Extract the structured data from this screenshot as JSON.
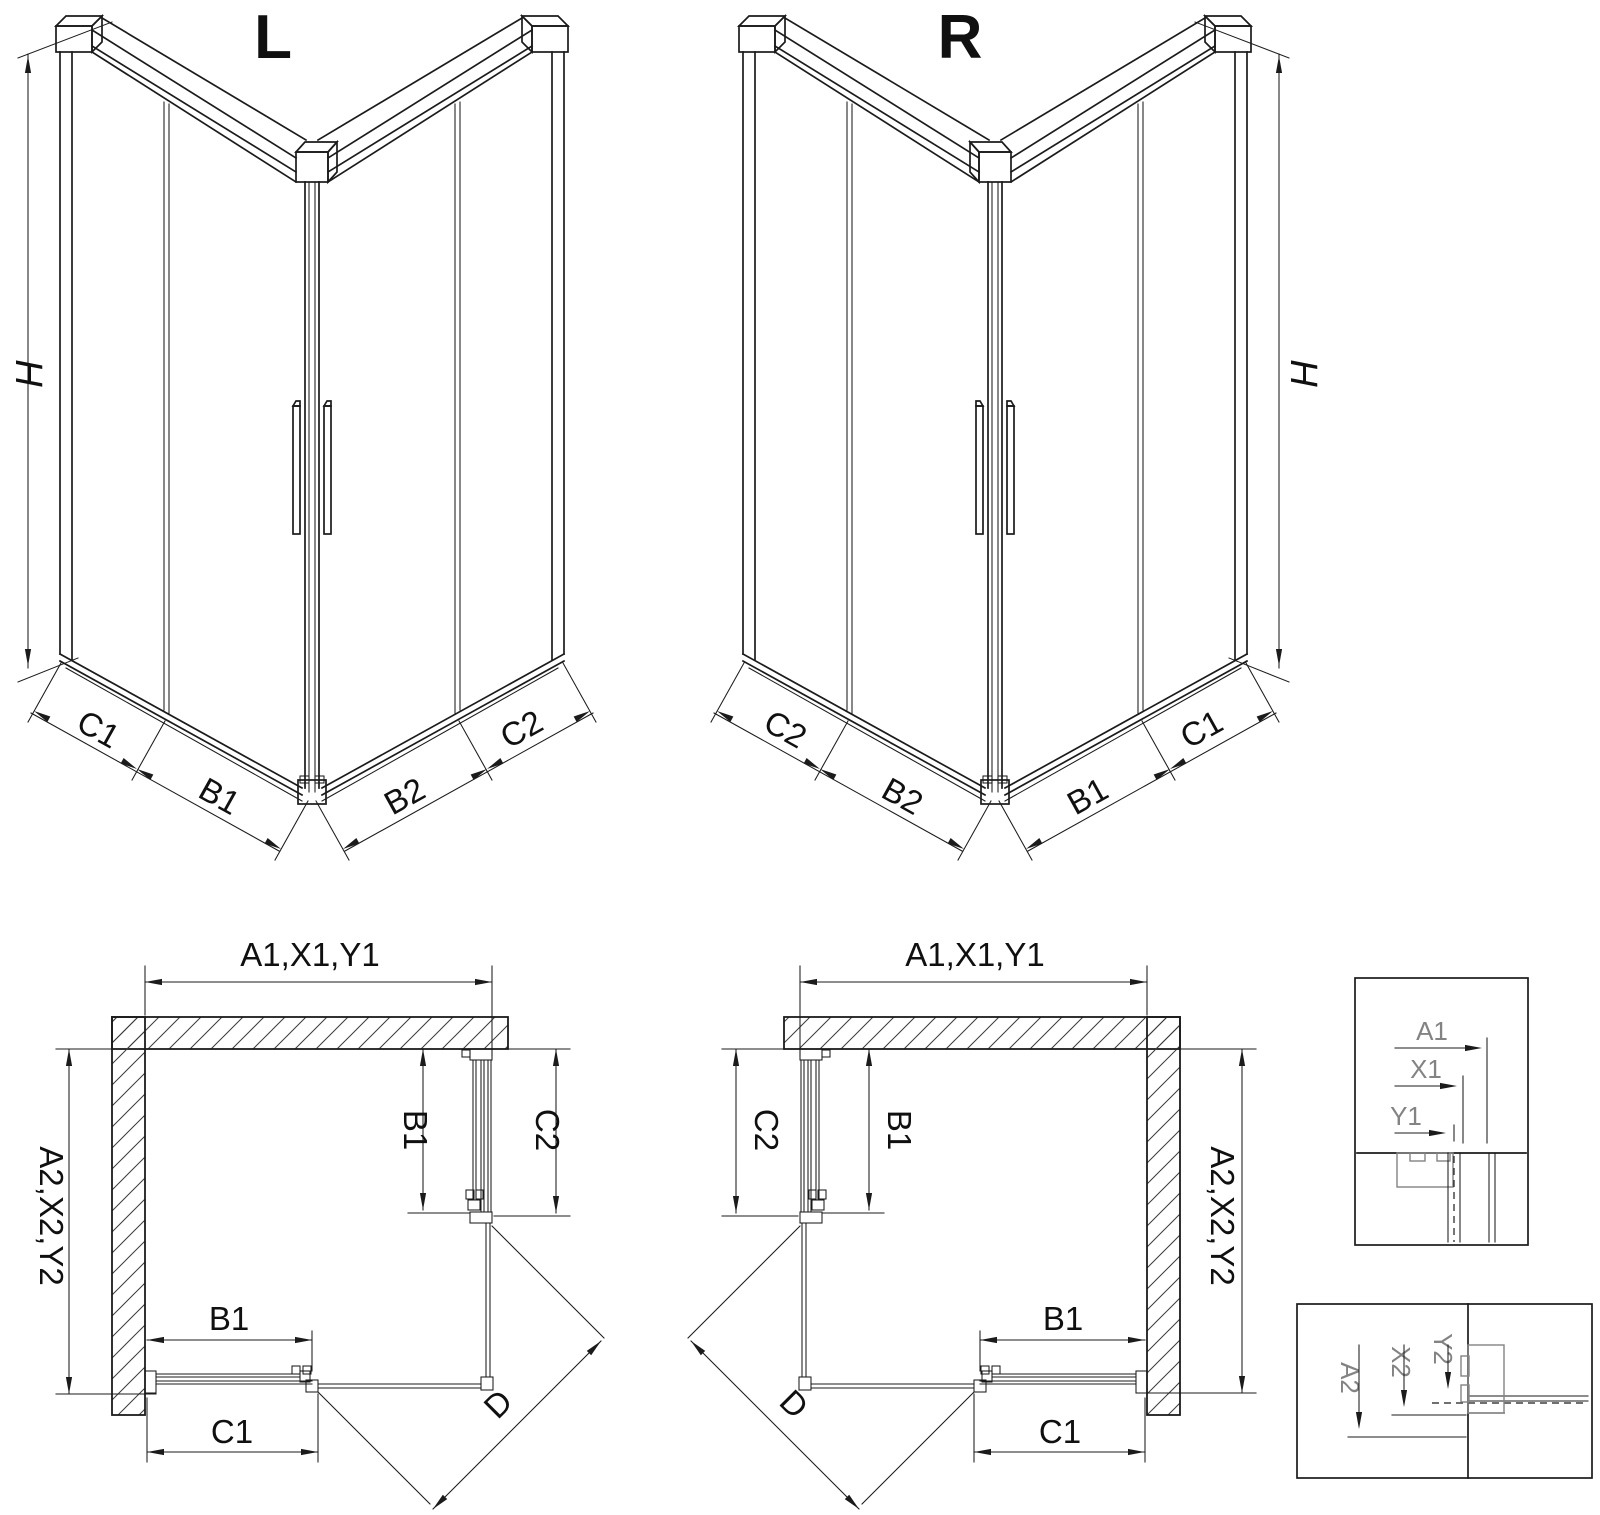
{
  "colors": {
    "line": "#1b1b1b",
    "detail_gray": "#838383",
    "background": "#ffffff"
  },
  "iso_left": {
    "title": "L",
    "height": "H",
    "widths": {
      "c1": "C1",
      "b1": "B1",
      "b2": "B2",
      "c2": "C2"
    }
  },
  "iso_right": {
    "title": "R",
    "height": "H",
    "widths": {
      "c1": "C1",
      "b1": "B1",
      "b2": "B2",
      "c2": "C2"
    }
  },
  "plan_left": {
    "width_total": "A1,X1,Y1",
    "depth_total": "A2,X2,Y2",
    "side_door": "B1",
    "side_panel": "C2",
    "front_door": "B1",
    "front_panel": "C1",
    "entry_width": "D"
  },
  "plan_right": {
    "width_total": "A1,X1,Y1",
    "depth_total": "A2,X2,Y2",
    "side_door": "B1",
    "side_panel": "C2",
    "front_door": "B1",
    "front_panel": "C1",
    "entry_width": "D"
  },
  "detail_width": {
    "a1": "A1",
    "x1": "X1",
    "y1": "Y1"
  },
  "detail_depth": {
    "a2": "A2",
    "x2": "X2",
    "y2": "Y2"
  }
}
